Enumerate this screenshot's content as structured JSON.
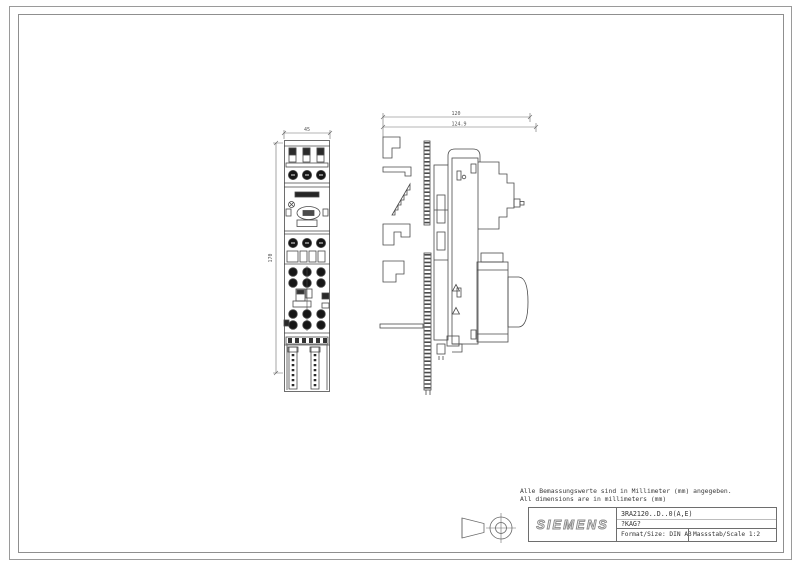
{
  "notes": {
    "de": "Alle Bemassungswerte sind in Millimeter (mm) angegeben.",
    "en": "All dimensions are in millimeters (mm)"
  },
  "title_block": {
    "brand": "SIEMENS",
    "part_number": "3RA2120..D..0(A,E)",
    "order_code": "?KAG?",
    "format": "Format/Size: DIN A3",
    "scale": "Massstab/Scale 1:2"
  },
  "dimensions": {
    "front_width_mm": "45",
    "front_height_mm": "170",
    "side_depth_upper_mm": "120",
    "side_depth_overall_mm": "124.9"
  },
  "colors": {
    "line": "#4a4a4a",
    "dim_line": "#6a6a6a",
    "fill_dark": "#1c1c1c",
    "border": "#8f8f8f"
  }
}
